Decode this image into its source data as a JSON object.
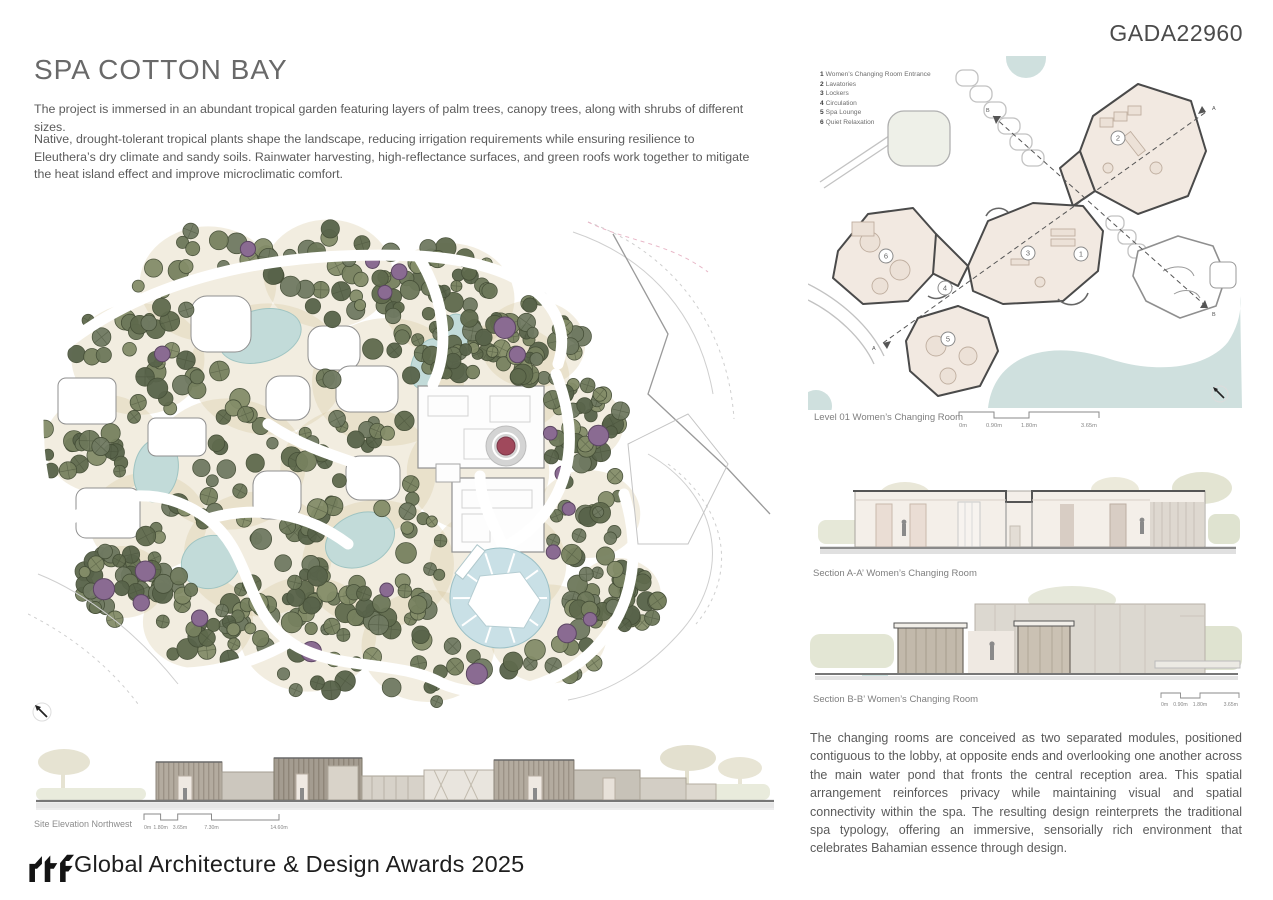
{
  "page": {
    "code": "GADA22960"
  },
  "title": "SPA COTTON BAY",
  "intro": {
    "p1": "The project is immersed in an abundant tropical garden featuring layers of palm trees, canopy trees, along with shrubs of different sizes.",
    "p2": "Native, drought-tolerant tropical plants shape the landscape, reducing irrigation requirements while ensuring resilience to Eleuthera’s dry climate and sandy soils. Rainwater harvesting, high-reflectance surfaces, and green roofs work together to mitigate the heat island effect and improve microclimatic comfort."
  },
  "floor_plan": {
    "caption": "Level 01 Women’s Changing Room",
    "legend": [
      {
        "num": "1",
        "label": "Women’s Changing Room Entrance"
      },
      {
        "num": "2",
        "label": "Lavatories"
      },
      {
        "num": "3",
        "label": "Lockers"
      },
      {
        "num": "4",
        "label": "Circulation"
      },
      {
        "num": "5",
        "label": "Spa Lounge"
      },
      {
        "num": "6",
        "label": "Quiet Relaxation"
      }
    ],
    "rooms": [
      "1",
      "2",
      "3",
      "4",
      "5",
      "6"
    ],
    "section_marks": [
      "A",
      "A",
      "B",
      "B"
    ],
    "scale": [
      "0m",
      "0.90m",
      "1.80m",
      "3.65m"
    ]
  },
  "sections": {
    "a_caption": "Section A-A’ Women’s Changing Room",
    "b_caption": "Section B-B’ Women’s Changing Room",
    "b_scale": [
      "0m",
      "0.90m",
      "1.80m",
      "3.65m"
    ]
  },
  "site_elevation": {
    "caption": "Site Elevation Northwest",
    "scale": [
      "0m",
      "1.80m",
      "3.65m",
      "7.30m",
      "14.60m"
    ]
  },
  "description": "The changing rooms are conceived as two separated modules, positioned contiguous to the lobby, at opposite ends and overlooking one another across the main water pond that fronts the central reception area. This spatial arrangement reinforces privacy while maintaining visual and spatial connectivity within the spa. The resulting design reinterprets the traditional spa typology, offering an immersive, sensorially rich environment that celebrates Bahamian essence through design.",
  "footer": {
    "logo": "rtf",
    "award": "Global Architecture & Design Awards 2025"
  },
  "colors": {
    "tree_greens": [
      "#6d785a",
      "#5f6a4d",
      "#77815f",
      "#848d69",
      "#58634a",
      "#707a62"
    ],
    "tree_stroke": "#454e37",
    "tree_purple": "#8a6b92",
    "purple_stroke": "#5c4663",
    "water": "#c2dbd9",
    "pool": "#c9e0e6",
    "sand": "#d8c7a0",
    "cream": "#f2e9e1",
    "dome_red": "#a0495c",
    "ink": "#4a4a4a"
  }
}
